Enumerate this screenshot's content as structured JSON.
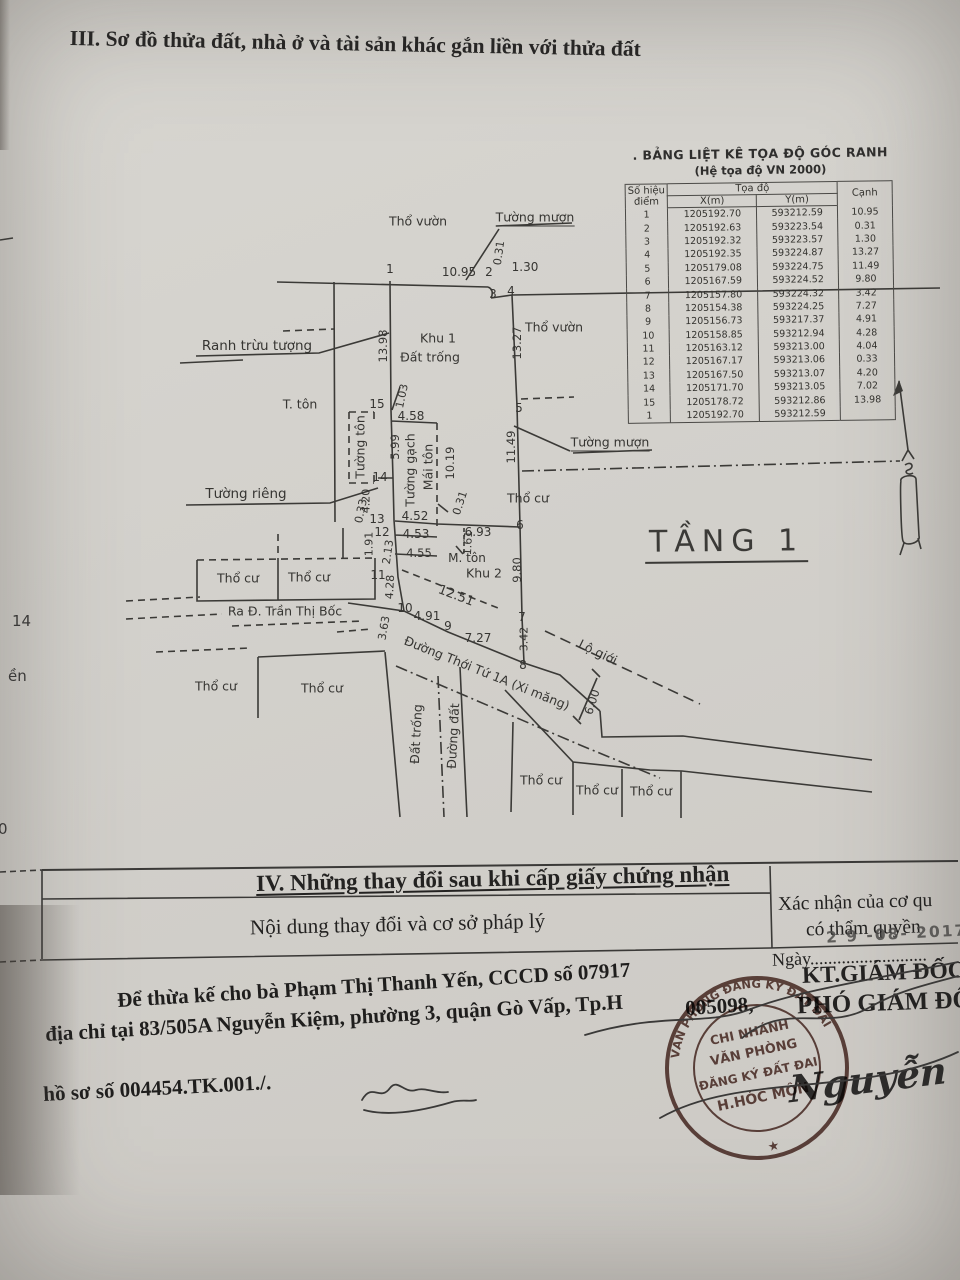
{
  "page": {
    "section3_title": "III. Sơ đồ thửa đất, nhà ở và tài sản khác gắn liền với thửa đất",
    "edge_fragments": [
      {
        "t": "14",
        "x": 12,
        "y": 612
      },
      {
        "t": "ền",
        "x": 8,
        "y": 667
      },
      {
        "t": "0",
        "x": -2,
        "y": 820
      }
    ]
  },
  "coord_table": {
    "title": ". BẢNG LIỆT KÊ TỌA ĐỘ GÓC RANH",
    "subtitle": "(Hệ tọa độ VN 2000)",
    "col_point_line1": "Số hiệu",
    "col_point_line2": "điểm",
    "col_coord": "Tọa độ",
    "col_x": "X(m)",
    "col_y": "Y(m)",
    "col_edge": "Cạnh",
    "rows": [
      [
        "1",
        "1205192.70",
        "593212.59",
        "10.95"
      ],
      [
        "2",
        "1205192.63",
        "593223.54",
        "0.31"
      ],
      [
        "3",
        "1205192.32",
        "593223.57",
        "1.30"
      ],
      [
        "4",
        "1205192.35",
        "593224.87",
        "13.27"
      ],
      [
        "5",
        "1205179.08",
        "593224.75",
        "11.49"
      ],
      [
        "6",
        "1205167.59",
        "593224.52",
        "9.80"
      ],
      [
        "7",
        "1205157.80",
        "593224.32",
        "3.42"
      ],
      [
        "8",
        "1205154.38",
        "593224.25",
        "7.27"
      ],
      [
        "9",
        "1205156.73",
        "593217.37",
        "4.91"
      ],
      [
        "10",
        "1205158.85",
        "593212.94",
        "4.28"
      ],
      [
        "11",
        "1205163.12",
        "593213.00",
        "4.04"
      ],
      [
        "12",
        "1205167.17",
        "593213.06",
        "0.33"
      ],
      [
        "13",
        "1205167.50",
        "593213.07",
        "4.20"
      ],
      [
        "14",
        "1205171.70",
        "593213.05",
        "7.02"
      ],
      [
        "15",
        "1205178.72",
        "593212.86",
        "13.98"
      ],
      [
        "1",
        "1205192.70",
        "593212.59",
        ""
      ]
    ]
  },
  "diagram": {
    "floor_label": "TẦNG 1",
    "labels": [
      {
        "t": "Thổ vườn",
        "x": 418,
        "y": 221
      },
      {
        "t": "Tường mượn",
        "x": 535,
        "y": 218,
        "u": 1
      },
      {
        "t": "Ranh trừu tượng",
        "x": 257,
        "y": 346,
        "fs": 13.5
      },
      {
        "t": "Khu 1",
        "x": 438,
        "y": 338
      },
      {
        "t": "Đất trống",
        "x": 430,
        "y": 357
      },
      {
        "t": "Thổ vườn",
        "x": 554,
        "y": 327
      },
      {
        "t": "T. tôn",
        "x": 300,
        "y": 404
      },
      {
        "t": "Tường tôn",
        "x": 360,
        "y": 447,
        "r": -90
      },
      {
        "t": "Tường gạch",
        "x": 410,
        "y": 470,
        "r": -90
      },
      {
        "t": "Mái tôn",
        "x": 428,
        "y": 467,
        "r": -90
      },
      {
        "t": "Tường riêng",
        "x": 246,
        "y": 494,
        "fs": 13.5
      },
      {
        "t": "Tường mượn",
        "x": 610,
        "y": 443,
        "u": 1
      },
      {
        "t": "Thổ cư",
        "x": 528,
        "y": 498
      },
      {
        "t": "M. tôn",
        "x": 467,
        "y": 558,
        "fs": 12
      },
      {
        "t": "Khu 2",
        "x": 484,
        "y": 573
      },
      {
        "t": "Thổ cư",
        "x": 238,
        "y": 578
      },
      {
        "t": "Thổ cư",
        "x": 309,
        "y": 577
      },
      {
        "t": "Ra Đ. Trần Thị Bốc",
        "x": 285,
        "y": 611
      },
      {
        "t": "Đường Thới Tứ 1A (Xi măng)",
        "x": 487,
        "y": 673,
        "r": 22
      },
      {
        "t": "Lộ giới",
        "x": 598,
        "y": 652,
        "r": 26
      },
      {
        "t": "Thổ cư",
        "x": 216,
        "y": 686
      },
      {
        "t": "Thổ cư",
        "x": 322,
        "y": 688
      },
      {
        "t": "Đất trống",
        "x": 416,
        "y": 734,
        "r": -87
      },
      {
        "t": "Đường đất",
        "x": 453,
        "y": 736,
        "r": -87
      },
      {
        "t": "Thổ cư",
        "x": 541,
        "y": 780
      },
      {
        "t": "Thổ cư",
        "x": 597,
        "y": 790
      },
      {
        "t": "Thổ cư",
        "x": 651,
        "y": 791
      },
      {
        "t": "1",
        "x": 390,
        "y": 269,
        "fs": 12
      },
      {
        "t": "10.95",
        "x": 459,
        "y": 272,
        "fs": 12
      },
      {
        "t": "2",
        "x": 489,
        "y": 272,
        "fs": 12
      },
      {
        "t": "0.31",
        "x": 499,
        "y": 253,
        "r": -82,
        "fs": 11
      },
      {
        "t": "1.30",
        "x": 525,
        "y": 267,
        "fs": 12
      },
      {
        "t": "3",
        "x": 493,
        "y": 294,
        "fs": 12
      },
      {
        "t": "4",
        "x": 511,
        "y": 291,
        "fs": 12
      },
      {
        "t": "13.98",
        "x": 383,
        "y": 346,
        "r": -90,
        "fs": 11.5
      },
      {
        "t": "13.27",
        "x": 517,
        "y": 343,
        "r": -90,
        "fs": 11.5
      },
      {
        "t": "15",
        "x": 377,
        "y": 404,
        "fs": 12
      },
      {
        "t": "1.03",
        "x": 402,
        "y": 396,
        "r": -78,
        "fs": 11
      },
      {
        "t": "4.58",
        "x": 411,
        "y": 416,
        "fs": 12
      },
      {
        "t": "5",
        "x": 519,
        "y": 408,
        "fs": 12
      },
      {
        "t": "5.99",
        "x": 395,
        "y": 447,
        "r": -90,
        "fs": 11.5
      },
      {
        "t": "14",
        "x": 380,
        "y": 477,
        "fs": 12
      },
      {
        "t": "10.19",
        "x": 450,
        "y": 463,
        "r": -90,
        "fs": 11.5
      },
      {
        "t": "11.49",
        "x": 511,
        "y": 447,
        "r": -90,
        "fs": 11.5
      },
      {
        "t": "4.20",
        "x": 366,
        "y": 501,
        "r": -90,
        "fs": 11
      },
      {
        "t": "0.33",
        "x": 361,
        "y": 511,
        "r": -78,
        "fs": 11
      },
      {
        "t": "13",
        "x": 377,
        "y": 519,
        "fs": 12
      },
      {
        "t": "4.52",
        "x": 415,
        "y": 516,
        "fs": 12
      },
      {
        "t": "0.31",
        "x": 460,
        "y": 503,
        "r": -72,
        "fs": 11
      },
      {
        "t": "12",
        "x": 382,
        "y": 532,
        "fs": 12
      },
      {
        "t": "4.53",
        "x": 416,
        "y": 534,
        "fs": 12
      },
      {
        "t": "6.93",
        "x": 478,
        "y": 532,
        "fs": 12
      },
      {
        "t": "6",
        "x": 520,
        "y": 525,
        "fs": 12
      },
      {
        "t": "1.91",
        "x": 369,
        "y": 544,
        "r": -90,
        "fs": 11
      },
      {
        "t": "2.13",
        "x": 388,
        "y": 552,
        "r": -82,
        "fs": 11
      },
      {
        "t": "4.55",
        "x": 419,
        "y": 553,
        "fs": 11.5
      },
      {
        "t": "1.61",
        "x": 468,
        "y": 543,
        "r": -87,
        "fs": 11
      },
      {
        "t": "11",
        "x": 378,
        "y": 575,
        "fs": 12
      },
      {
        "t": "9.80",
        "x": 517,
        "y": 570,
        "r": -90,
        "fs": 11.5
      },
      {
        "t": "4.28",
        "x": 390,
        "y": 587,
        "r": -87,
        "fs": 11
      },
      {
        "t": "10",
        "x": 405,
        "y": 608,
        "fs": 12
      },
      {
        "t": "4.91",
        "x": 427,
        "y": 616,
        "fs": 12
      },
      {
        "t": "9",
        "x": 448,
        "y": 626,
        "fs": 12
      },
      {
        "t": "7.27",
        "x": 478,
        "y": 638,
        "fs": 12
      },
      {
        "t": "3.63",
        "x": 384,
        "y": 628,
        "r": -80,
        "fs": 11
      },
      {
        "t": "7",
        "x": 522,
        "y": 617,
        "fs": 12
      },
      {
        "t": "3.42",
        "x": 524,
        "y": 639,
        "r": -90,
        "fs": 11
      },
      {
        "t": "8",
        "x": 523,
        "y": 665,
        "fs": 12
      },
      {
        "t": "12.51",
        "x": 456,
        "y": 596,
        "r": 21,
        "fs": 13
      },
      {
        "t": "6.00",
        "x": 592,
        "y": 702,
        "r": -72,
        "fs": 11.5
      }
    ]
  },
  "section4": {
    "title": "IV. Những thay đổi sau khi cấp giấy chứng nhận",
    "left_header": "Nội dung thay đổi và cơ sở pháp lý",
    "right_header_line1": "Xác nhận của cơ qu",
    "right_header_line2": "có thẩm quyền",
    "date_line": "Ngày..........................",
    "date_stamp": "2 9  -08-  2017",
    "sign_title1": "KT.GIÁM ĐỐC",
    "sign_title2": "PHÓ GIÁM ĐỐC",
    "body_line1": "Để thừa kế cho bà Phạm Thị Thanh Yến, CCCD số 07917",
    "body_line1b": "005098,",
    "body_line2": "địa chỉ tại 83/505A Nguyễn Kiệm, phường 3, quận Gò Vấp, Tp.H",
    "body_line3": "hồ sơ số 004454.TK.001./.",
    "signature_name": "Nguyễn Tấn Ph",
    "stamp": {
      "ring_text": "VĂN PHÒNG ĐĂNG KÝ ĐẤT ĐAI",
      "center_line1": "CHI NHÁNH",
      "center_line2": "VĂN PHÒNG",
      "center_line3": "ĐĂNG KÝ ĐẤT ĐAI",
      "center_line4": "H.HÓC MÔN",
      "star": "★",
      "color": "#55312a"
    }
  },
  "colors": {
    "paper": "#d3d1cc",
    "ink": "#2f2e2d",
    "line": "#3b3a37",
    "stamp": "#55312a"
  }
}
